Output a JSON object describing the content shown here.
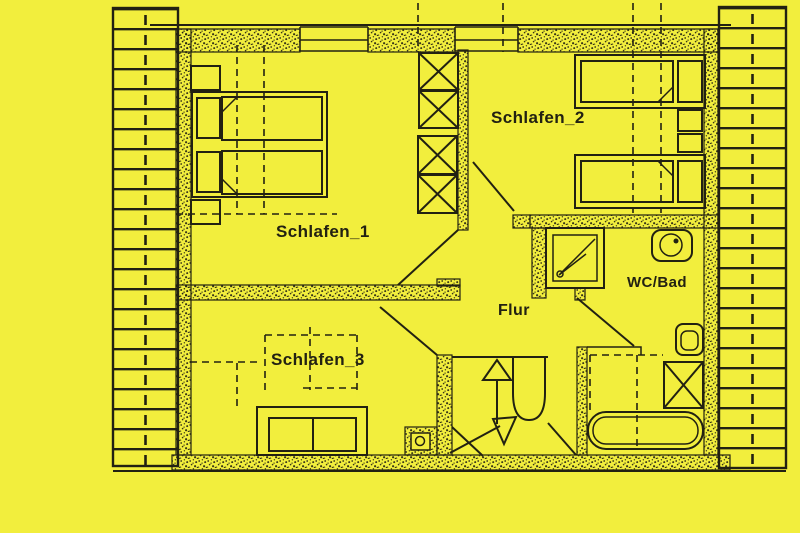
{
  "colors": {
    "background": "#f2ee3d",
    "ink": "#222112"
  },
  "plan": {
    "type": "floor-plan",
    "rooms": [
      {
        "id": "schlafen1",
        "label": "Schlafen_1"
      },
      {
        "id": "schlafen2",
        "label": "Schlafen_2"
      },
      {
        "id": "schlafen3",
        "label": "Schlafen_3"
      },
      {
        "id": "flur",
        "label": "Flur"
      },
      {
        "id": "wc_bad",
        "label": "WC/Bad"
      }
    ],
    "fixtures": [
      "double-bed",
      "single-bed",
      "single-bed",
      "sofa-bed",
      "wardrobe",
      "shower",
      "sink",
      "toilet",
      "bathtub",
      "bath-cabinet",
      "winder-stairs",
      "stair-arrow-up",
      "stair-arrow-down",
      "duct-box"
    ],
    "roof_hatch": {
      "left": true,
      "right": true
    }
  }
}
